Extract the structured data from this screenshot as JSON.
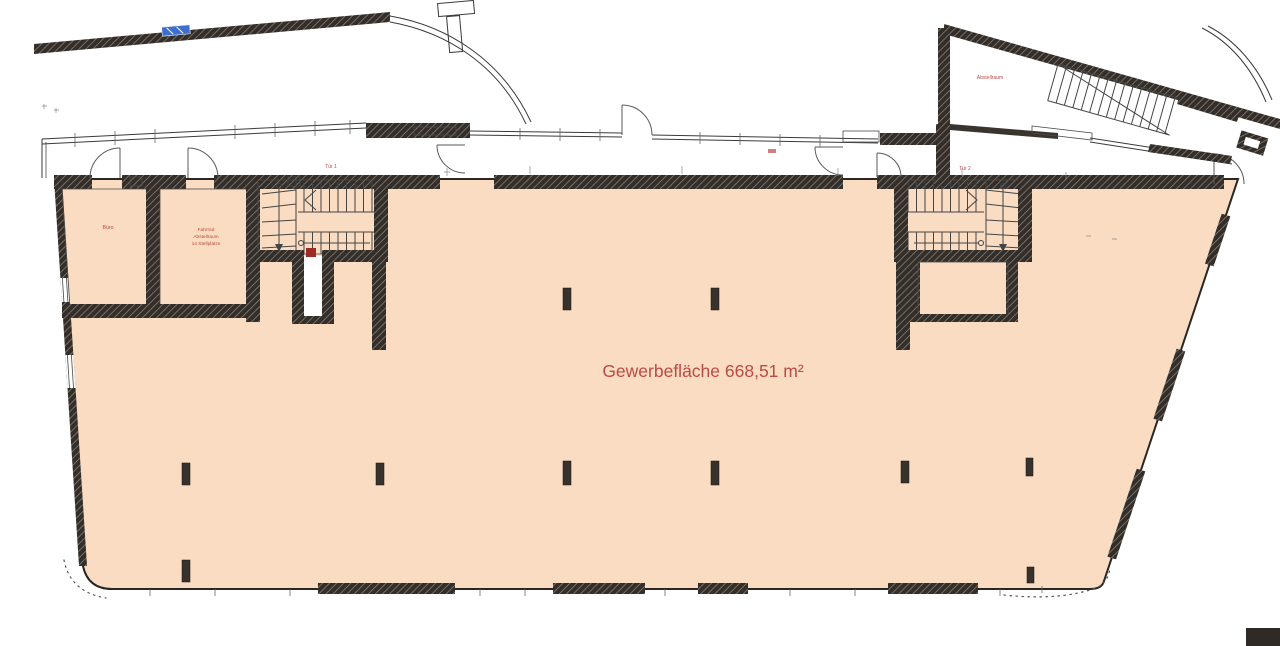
{
  "plan": {
    "area_label": "Gewerbefläche 668,51 m²",
    "rooms": {
      "office": "Büro",
      "bike_line1": "Fahrrad",
      "bike_line2": "Abstellraum",
      "bike_line3": "14 Stellplätze",
      "storage": "Abstellraum"
    },
    "doors": {
      "door1": "Tür 1",
      "door2": "Tür 2"
    },
    "colors": {
      "area_fill": "#f9dcc1",
      "label_red": "#bc4a45",
      "wall_dark": "#332e29",
      "window_blue": "#3d6fd0"
    }
  }
}
